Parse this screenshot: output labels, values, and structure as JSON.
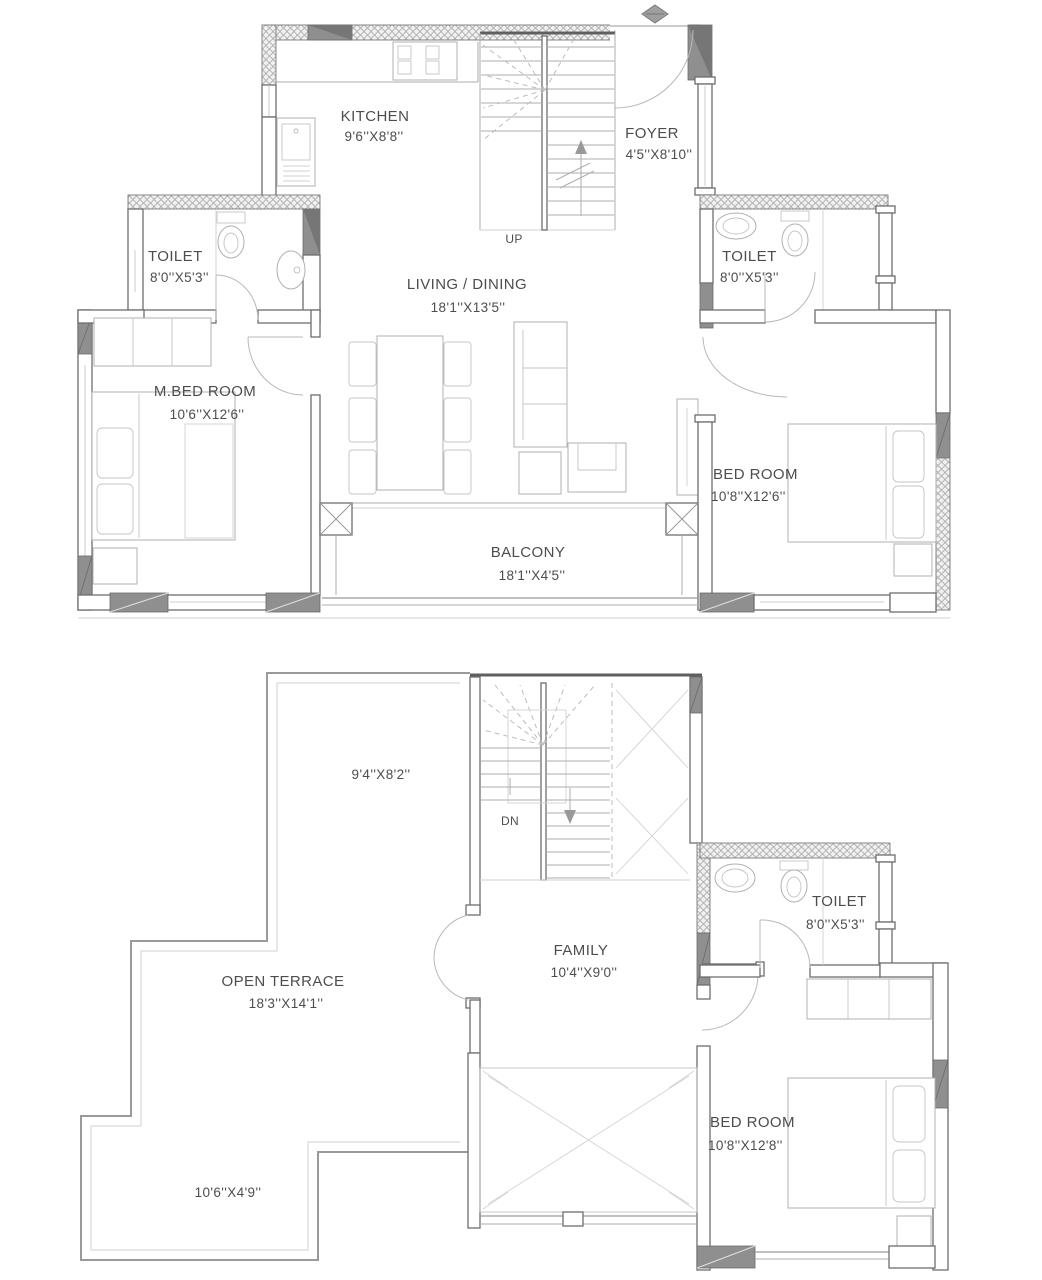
{
  "page": {
    "background": "#ffffff",
    "wall_line_color": "#6e6e6e",
    "column_fill_color": "#8f8f8f",
    "text_color": "#4d4d4d"
  },
  "upper_plan": {
    "kitchen": {
      "name": "KITCHEN",
      "dims": "9'6''X8'8''"
    },
    "foyer": {
      "name": "FOYER",
      "dims": "4'5''X8'10''"
    },
    "stairs": {
      "label": "UP"
    },
    "toilet_left": {
      "name": "TOILET",
      "dims": "8'0''X5'3''"
    },
    "toilet_right": {
      "name": "TOILET",
      "dims": "8'0''X5'3''"
    },
    "living_dining": {
      "name": "LIVING / DINING",
      "dims": "18'1''X13'5''"
    },
    "master_bedroom": {
      "name": "M.BED ROOM",
      "dims": "10'6''X12'6''"
    },
    "bedroom": {
      "name": "BED ROOM",
      "dims": "10'8''X12'6''"
    },
    "balcony": {
      "name": "BALCONY",
      "dims": "18'1''X4'5''"
    }
  },
  "lower_plan": {
    "stair_area": {
      "dims": "9'4''X8'2''",
      "label": "DN"
    },
    "open_terrace": {
      "name": "OPEN TERRACE",
      "dims": "18'3''X14'1''"
    },
    "family": {
      "name": "FAMILY",
      "dims": "10'4''X9'0''"
    },
    "toilet": {
      "name": "TOILET",
      "dims": "8'0''X5'3''"
    },
    "bedroom": {
      "name": "BED ROOM",
      "dims": "10'8''X12'8''"
    },
    "terrace_strip": {
      "dims": "10'6''X4'9''"
    }
  }
}
